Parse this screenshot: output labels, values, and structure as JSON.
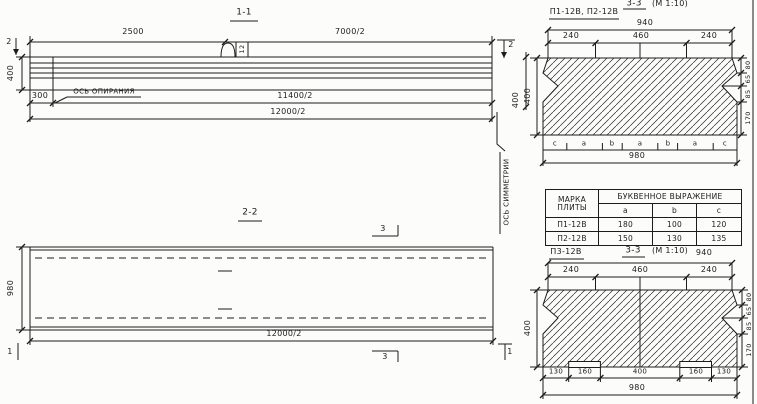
{
  "section_1_1": {
    "title": "1-1",
    "dim_2500": "2500",
    "dim_7000_2": "7000/2",
    "dim_400_left": "400",
    "dim_400_right": "400",
    "dim_300": "300",
    "support_axis_label": "ОСЬ ОПИРАНИЯ",
    "dim_11400_2": "11400/2",
    "dim_12000_2": "12000/2",
    "loop_mark": "12",
    "cut_left": "2",
    "cut_right": "2"
  },
  "symmetry_axis_label": "ОСЬ СИММЕТРИИ",
  "section_2_2": {
    "title": "2-2",
    "dim_980": "980",
    "dim_12000_2": "12000/2",
    "cut_3_top": "3",
    "cut_3_bottom": "3",
    "cut_1_left": "1",
    "cut_1_right": "1"
  },
  "section_3_3_top": {
    "label": "П1-12В, П2-12В",
    "title": "3-3",
    "scale": "(М 1:10)",
    "dim_940": "940",
    "dim_240_l": "240",
    "dim_460": "460",
    "dim_240_r": "240",
    "dim_400": "400",
    "right_dims": [
      "80",
      "65",
      "85",
      "170"
    ],
    "letters": [
      "c",
      "a",
      "b",
      "a",
      "b",
      "a",
      "c"
    ],
    "dim_980": "980"
  },
  "table": {
    "header_mark_line1": "МАРКА",
    "header_mark_line2": "ПЛИТЫ",
    "header_span": "БУКВЕННОЕ  ВЫРАЖЕНИЕ",
    "col_a": "a",
    "col_b": "b",
    "col_c": "c",
    "rows": [
      {
        "mark": "П1-12В",
        "a": "180",
        "b": "100",
        "c": "120"
      },
      {
        "mark": "П2-12В",
        "a": "150",
        "b": "130",
        "c": "135"
      }
    ]
  },
  "section_3_3_bottom": {
    "label": "П3-12В",
    "title": "3-3",
    "scale": "(М 1:10)",
    "dim_940": "940",
    "dim_240_l": "240",
    "dim_460": "460",
    "dim_240_r": "240",
    "dim_400": "400",
    "right_dims": [
      "80",
      "65",
      "85",
      "170"
    ],
    "bottom_dims": [
      "130",
      "160",
      "400",
      "160",
      "130"
    ],
    "dim_980": "980"
  }
}
